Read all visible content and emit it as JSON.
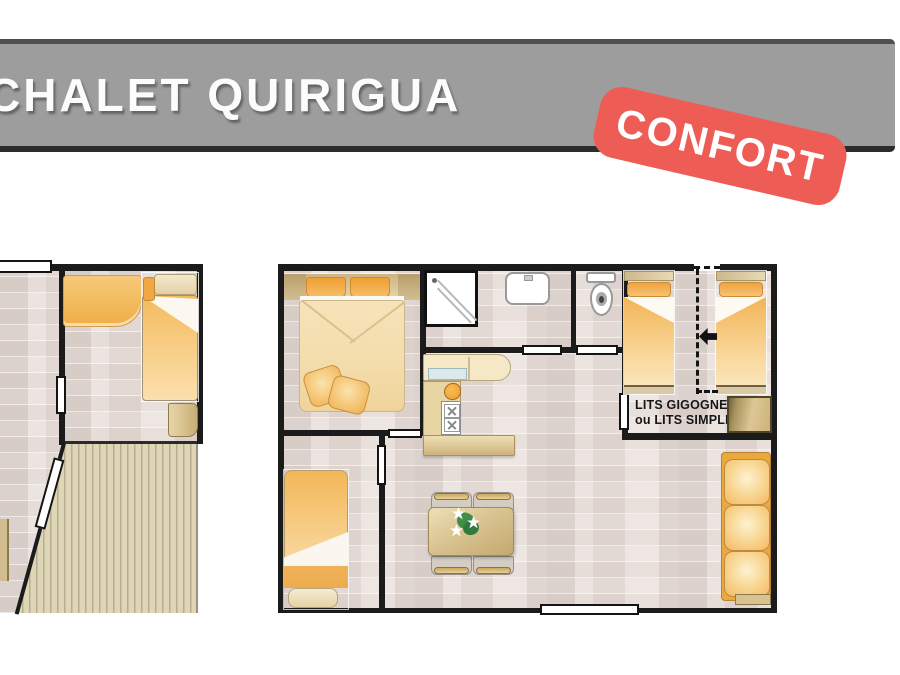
{
  "header": {
    "title": "CHALET QUIRIGUA"
  },
  "badge": {
    "label": "CONFORT"
  },
  "plan": {
    "beds_label": {
      "line1": "LITS GIGOGNES",
      "line2": "ou LITS SIMPLES"
    },
    "furniture": [
      "double-bed",
      "single-bed-left-plan",
      "single-bed-bedroom2",
      "kids-single-bed-left",
      "kids-single-bed-right",
      "corner-bench",
      "shower",
      "washbasin",
      "toilet",
      "kitchen-bench",
      "kitchen-hob-unit",
      "kitchen-counter",
      "dining-table",
      "chair",
      "sofa-3-seater",
      "wardrobe-cabinet",
      "terrace-deck"
    ]
  },
  "colors": {
    "banner_gray": "#9d9d9d",
    "banner_border_top": "#4f4f4f",
    "banner_border_bottom": "#2c2c2c",
    "badge_coral": "#ee5d55",
    "wall_black": "#1b1b1b",
    "floor_base": "#ebe4e0",
    "bed_orange": "#f3b85a",
    "duvet_cream": "#f6e3b9",
    "counter_tan": "#d9c28d",
    "deck_beige": "#ded6b7",
    "plant_green": "#3f8f4a"
  }
}
